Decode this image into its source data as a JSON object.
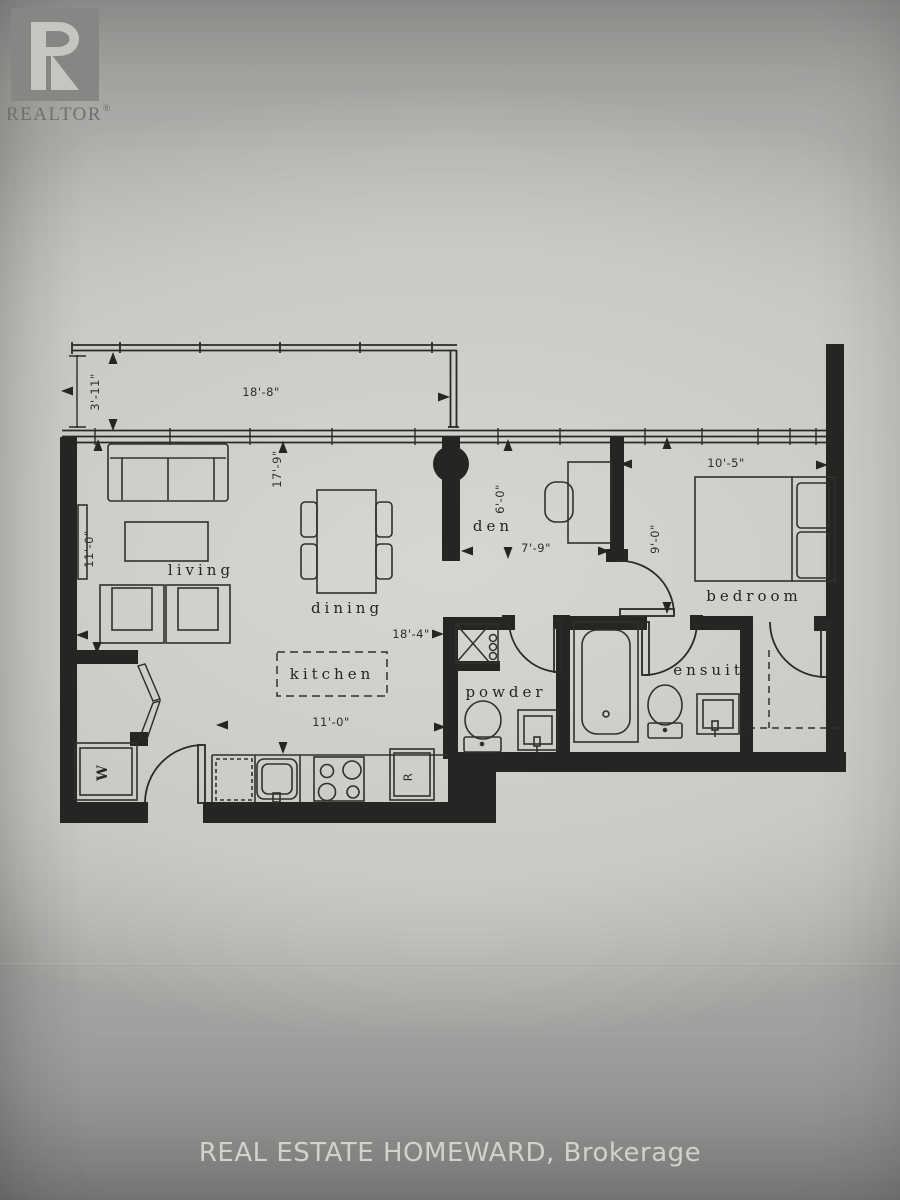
{
  "logo": {
    "letter": "R",
    "wordmark": "REALTOR",
    "registered": "®"
  },
  "footer": {
    "brokerage_line": "REAL ESTATE HOMEWARD, Brokerage"
  },
  "floor_plan": {
    "room_labels": {
      "living": "living",
      "dining": "dining",
      "kitchen": "kitchen",
      "den": "den",
      "powder": "powder",
      "bedroom": "bedroom",
      "ensuite": "ensuite"
    },
    "dimensions": {
      "balcony_width": "18'-8\"",
      "balcony_depth": "3'-11\"",
      "living_dining_depth": "17'-9\"",
      "living_width": "11'-0\"",
      "den_depth": "6'-0\"",
      "den_width": "7'-9\"",
      "bedroom_width": "10'-5\"",
      "bedroom_depth": "9'-0\"",
      "kitchen_hall_run": "18'-4\"",
      "kitchen_width": "11'-0\""
    },
    "appliance_labels": {
      "washer": "W",
      "fridge": "R"
    }
  },
  "colors": {
    "ink": "#252523",
    "paper": "#d6d4d0",
    "photo_gray": "#a8a7a4",
    "logo_gray": "#868684"
  }
}
